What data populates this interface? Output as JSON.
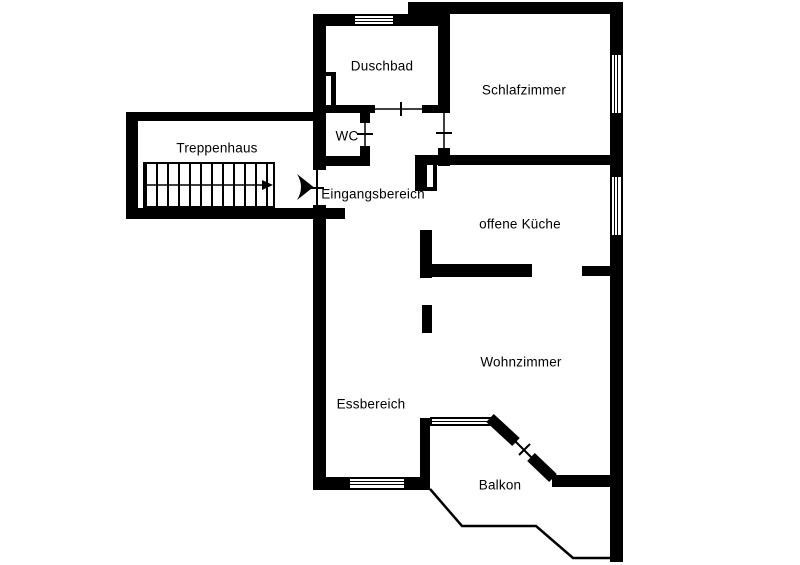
{
  "floorplan": {
    "rooms": {
      "treppenhaus": {
        "label": "Treppenhaus"
      },
      "duschbad": {
        "label": "Duschbad"
      },
      "wc": {
        "label": "WC"
      },
      "eingangsbereich": {
        "label": "Eingangsbereich"
      },
      "schlafzimmer": {
        "label": "Schlafzimmer"
      },
      "offene_kueche": {
        "label": "offene Küche"
      },
      "wohnzimmer": {
        "label": "Wohnzimmer"
      },
      "essbereich": {
        "label": "Essbereich"
      },
      "balkon": {
        "label": "Balkon"
      }
    },
    "colors": {
      "wall": "#000000",
      "background": "#ffffff",
      "text": "#000000"
    }
  }
}
